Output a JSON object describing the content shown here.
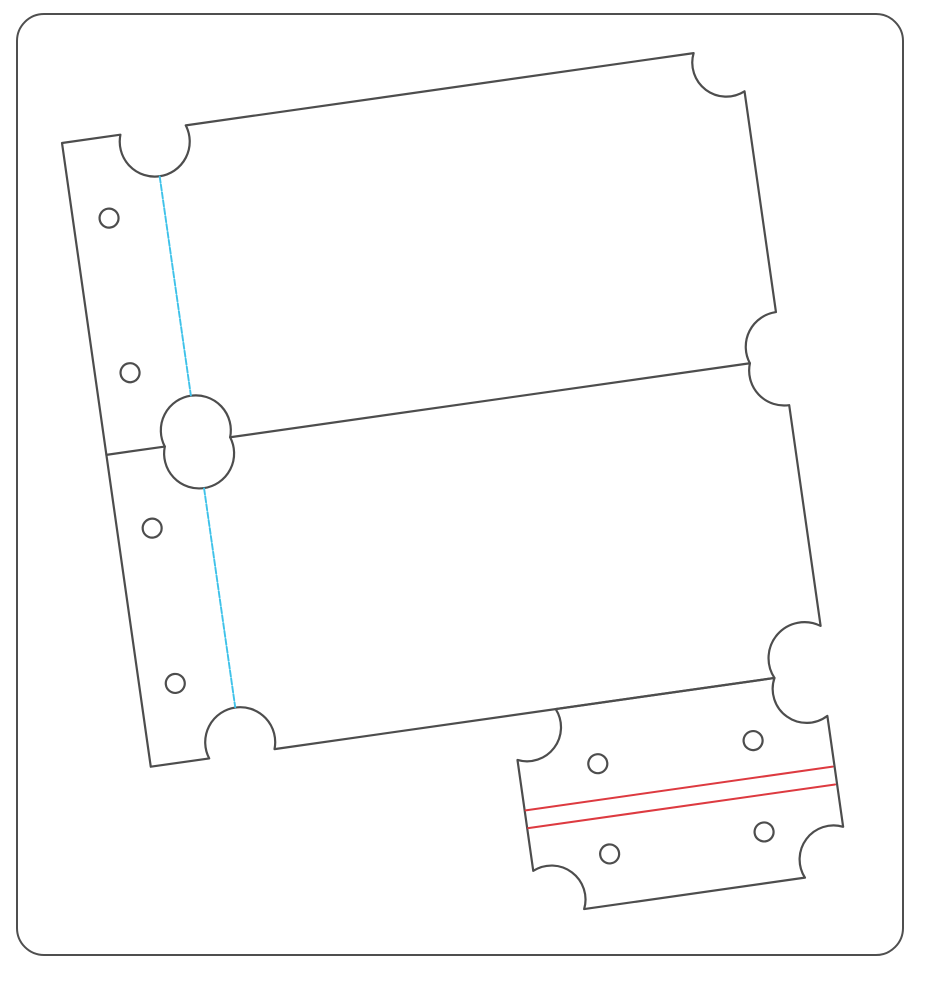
{
  "scene": {
    "background_color": "#ffffff"
  },
  "colors": {
    "frame_stroke": "#4f4f4f",
    "die_stroke": "#4d4d4d",
    "perforation_stroke": "#3fc2e9",
    "stitch_stroke": "#dd3a40",
    "fill": "#ffffff"
  },
  "large_panel": {
    "ticket_count": 2,
    "hole_count": 4,
    "perforation_segments": 2
  },
  "small_ticket": {
    "hole_count": 4,
    "stitch_line_count": 2
  }
}
